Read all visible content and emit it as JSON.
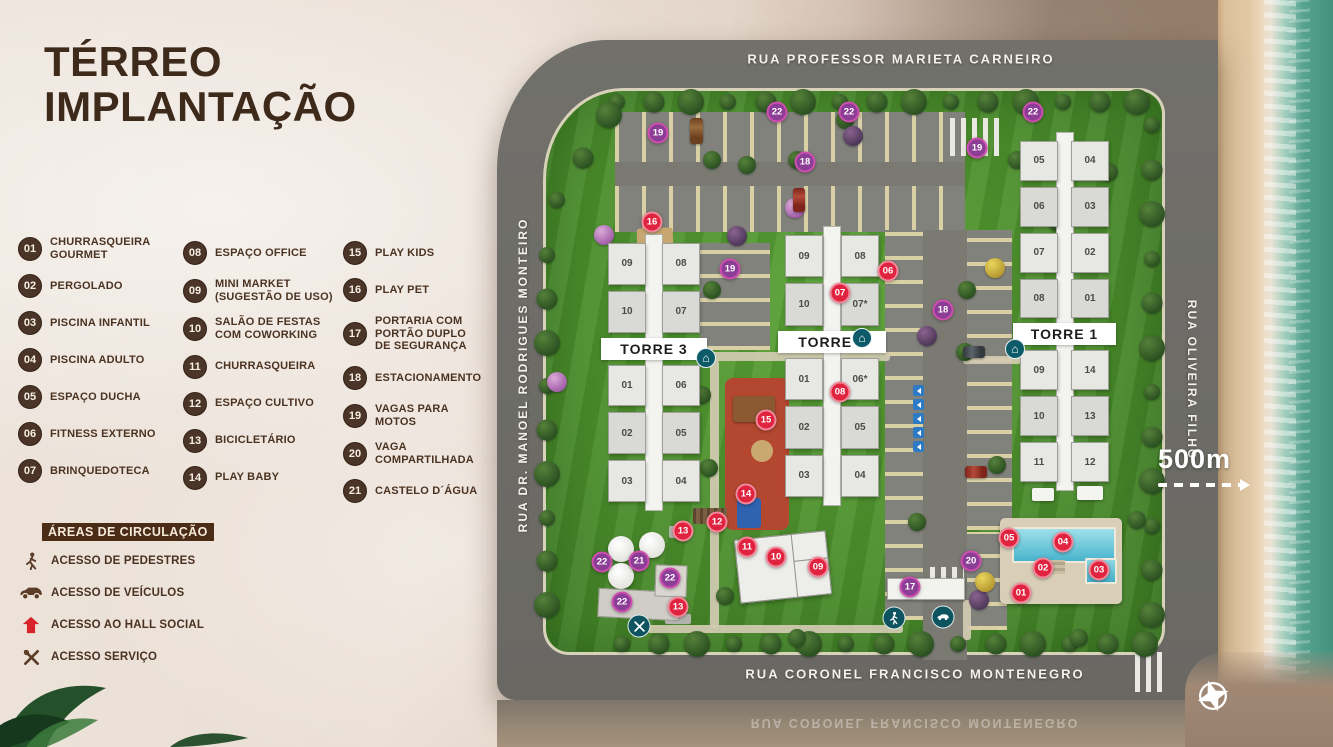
{
  "title": {
    "line1": "TÉRREO",
    "line2": "IMPLANTAÇÃO"
  },
  "legend": {
    "columns": [
      [
        {
          "num": "01",
          "label": "CHURRASQUEIRA\nGOURMET"
        },
        {
          "num": "02",
          "label": "PERGOLADO"
        },
        {
          "num": "03",
          "label": "PISCINA INFANTIL"
        },
        {
          "num": "04",
          "label": "PISCINA ADULTO"
        },
        {
          "num": "05",
          "label": "ESPAÇO DUCHA"
        },
        {
          "num": "06",
          "label": "FITNESS EXTERNO"
        },
        {
          "num": "07",
          "label": "BRINQUEDOTECA"
        }
      ],
      [
        {
          "num": "08",
          "label": "ESPAÇO OFFICE"
        },
        {
          "num": "09",
          "label": "MINI MARKET\n(SUGESTÃO DE USO)"
        },
        {
          "num": "10",
          "label": "SALÃO DE FESTAS\nCOM COWORKING"
        },
        {
          "num": "11",
          "label": "CHURRASQUEIRA"
        },
        {
          "num": "12",
          "label": "ESPAÇO CULTIVO"
        },
        {
          "num": "13",
          "label": "BICICLETÁRIO"
        },
        {
          "num": "14",
          "label": "PLAY BABY"
        }
      ],
      [
        {
          "num": "15",
          "label": "PLAY KIDS"
        },
        {
          "num": "16",
          "label": "PLAY PET"
        },
        {
          "num": "17",
          "label": "PORTARIA COM\nPORTÃO DUPLO\nDE SEGURANÇA"
        },
        {
          "num": "18",
          "label": "ESTACIONAMENTO"
        },
        {
          "num": "19",
          "label": "VAGAS PARA\nMOTOS"
        },
        {
          "num": "20",
          "label": "VAGA\nCOMPARTILHADA"
        },
        {
          "num": "21",
          "label": "CASTELO D´ÁGUA"
        }
      ]
    ]
  },
  "circulation": {
    "heading": "ÁREAS DE CIRCULAÇÃO",
    "items": [
      {
        "icon": "pedestrian-icon",
        "label": "ACESSO DE PEDESTRES"
      },
      {
        "icon": "car-icon",
        "label": "ACESSO DE VEÍCULOS"
      },
      {
        "icon": "hall-icon",
        "label": "ACESSO AO HALL SOCIAL"
      },
      {
        "icon": "service-icon",
        "label": "ACESSO SERVIÇO"
      }
    ]
  },
  "map": {
    "streets": {
      "top": "RUA PROFESSOR MARIETA CARNEIRO",
      "left": "RUA DR. MANOEL RODRIGUES MONTEIRO",
      "right": "RUA OLIVEIRA FILHO",
      "bottom": "RUA CORONEL FRANCISCO MONTENEGRO"
    },
    "scale_label": "500m",
    "towers": [
      {
        "name": "TORRE 3",
        "label_after_row": 2,
        "rows": [
          [
            "09",
            "08"
          ],
          [
            "10",
            "07"
          ],
          [
            "01",
            "06"
          ],
          [
            "02",
            "05"
          ],
          [
            "03",
            "04"
          ]
        ]
      },
      {
        "name": "TORRE 2",
        "label_after_row": 2,
        "rows": [
          [
            "09",
            "08"
          ],
          [
            "10",
            "07*"
          ],
          [
            "01",
            "06*"
          ],
          [
            "02",
            "05"
          ],
          [
            "03",
            "04"
          ]
        ]
      },
      {
        "name": "TORRE 1",
        "label_after_row": 4,
        "rows": [
          [
            "05",
            "04"
          ],
          [
            "06",
            "03"
          ],
          [
            "07",
            "02"
          ],
          [
            "08",
            "01"
          ],
          [
            "09",
            "14"
          ],
          [
            "10",
            "13"
          ],
          [
            "11",
            "12"
          ]
        ]
      }
    ],
    "markers": [
      {
        "n": "19",
        "x": 161,
        "y": 93,
        "c": "p"
      },
      {
        "n": "22",
        "x": 280,
        "y": 72,
        "c": "p"
      },
      {
        "n": "22",
        "x": 352,
        "y": 72,
        "c": "p"
      },
      {
        "n": "22",
        "x": 536,
        "y": 72,
        "c": "p"
      },
      {
        "n": "19",
        "x": 480,
        "y": 108,
        "c": "p"
      },
      {
        "n": "18",
        "x": 308,
        "y": 122,
        "c": "p"
      },
      {
        "n": "16",
        "x": 155,
        "y": 182,
        "c": "r"
      },
      {
        "n": "19",
        "x": 233,
        "y": 229,
        "c": "p"
      },
      {
        "n": "06",
        "x": 391,
        "y": 231,
        "c": "r"
      },
      {
        "n": "07",
        "x": 343,
        "y": 253,
        "c": "r"
      },
      {
        "n": "18",
        "x": 446,
        "y": 270,
        "c": "p"
      },
      {
        "n": "08",
        "x": 343,
        "y": 352,
        "c": "r"
      },
      {
        "n": "15",
        "x": 269,
        "y": 380,
        "c": "r"
      },
      {
        "n": "14",
        "x": 249,
        "y": 454,
        "c": "r"
      },
      {
        "n": "12",
        "x": 220,
        "y": 482,
        "c": "r"
      },
      {
        "n": "13",
        "x": 186,
        "y": 491,
        "c": "r"
      },
      {
        "n": "11",
        "x": 250,
        "y": 507,
        "c": "r"
      },
      {
        "n": "10",
        "x": 279,
        "y": 517,
        "c": "r"
      },
      {
        "n": "09",
        "x": 321,
        "y": 527,
        "c": "r"
      },
      {
        "n": "22",
        "x": 105,
        "y": 522,
        "c": "p"
      },
      {
        "n": "21",
        "x": 142,
        "y": 521,
        "c": "p"
      },
      {
        "n": "22",
        "x": 173,
        "y": 538,
        "c": "p"
      },
      {
        "n": "22",
        "x": 125,
        "y": 562,
        "c": "p"
      },
      {
        "n": "13",
        "x": 181,
        "y": 567,
        "c": "r"
      },
      {
        "n": "17",
        "x": 413,
        "y": 547,
        "c": "p"
      },
      {
        "n": "20",
        "x": 474,
        "y": 521,
        "c": "p"
      },
      {
        "n": "05",
        "x": 512,
        "y": 498,
        "c": "r"
      },
      {
        "n": "04",
        "x": 566,
        "y": 502,
        "c": "r"
      },
      {
        "n": "02",
        "x": 546,
        "y": 528,
        "c": "r"
      },
      {
        "n": "03",
        "x": 602,
        "y": 530,
        "c": "r"
      },
      {
        "n": "01",
        "x": 524,
        "y": 553,
        "c": "r"
      }
    ]
  },
  "colors": {
    "brand_brown": "#4b3529",
    "title_brown": "#3e2a1b",
    "marker_red": "#e0233f",
    "marker_purple": "#8c3d96",
    "accent_red": "#d8232a",
    "access_teal": "#0d5460",
    "grass_green": "#4a8c2b",
    "asphalt_gray": "#6f6e69"
  }
}
